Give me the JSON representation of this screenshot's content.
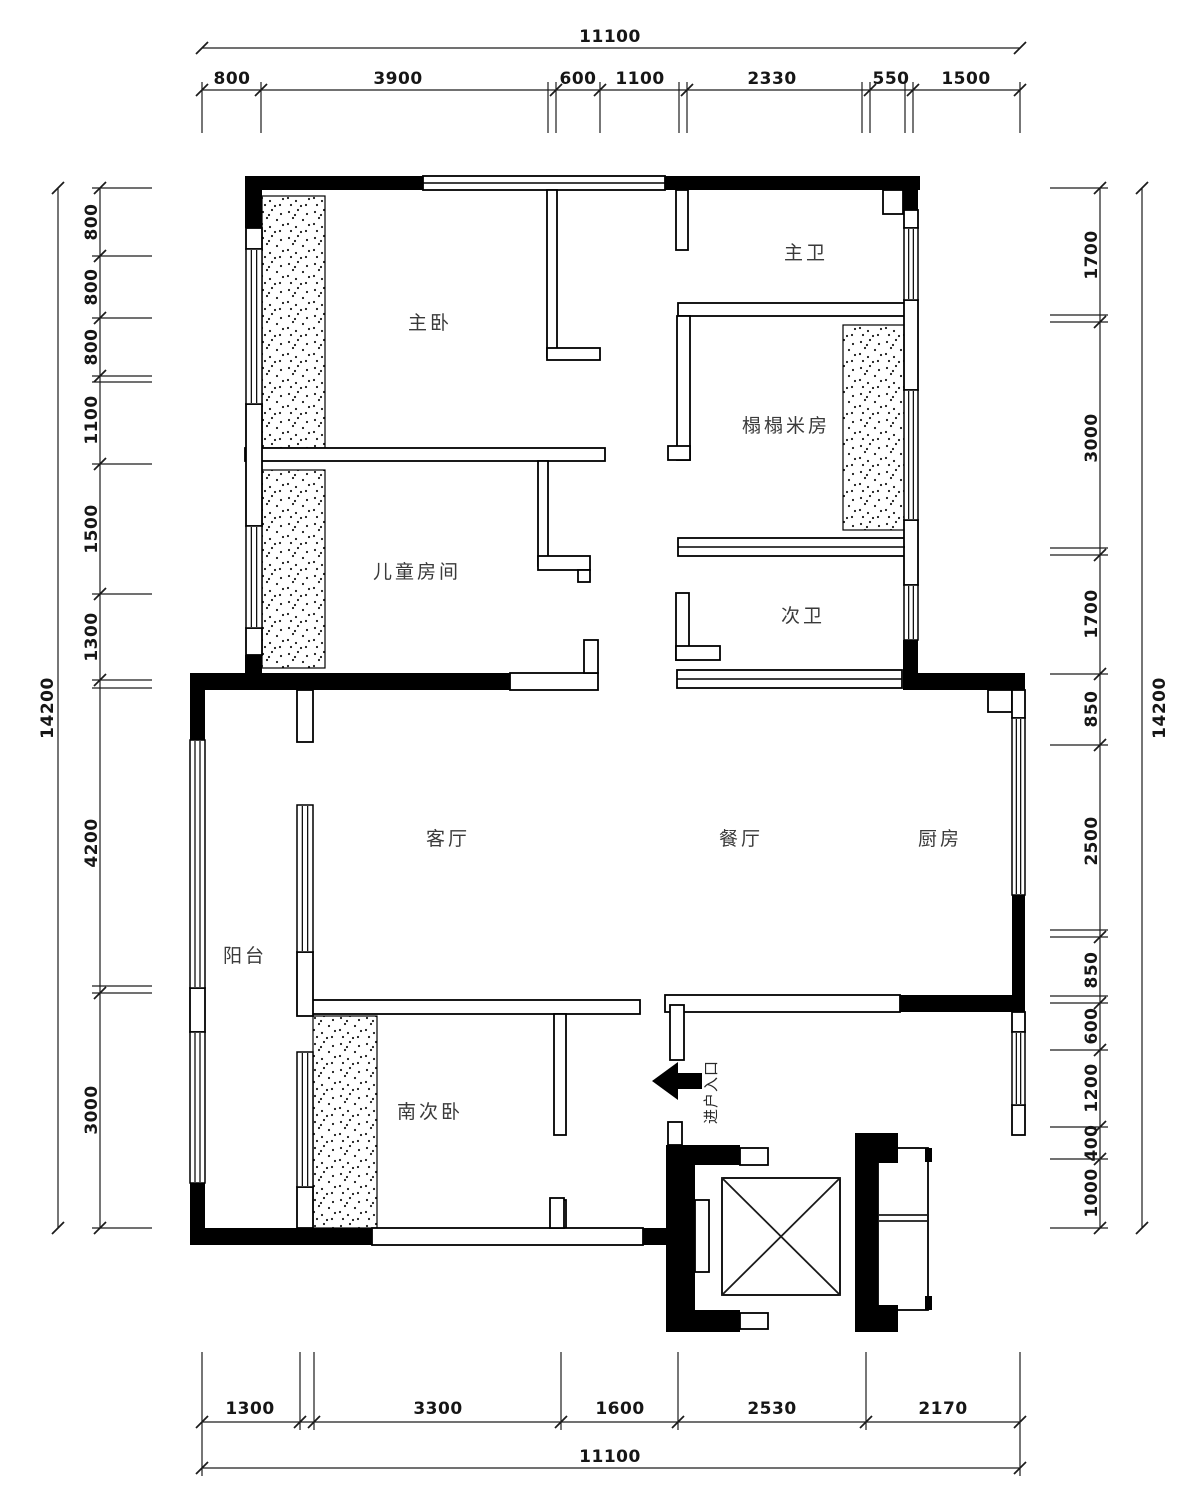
{
  "plan": {
    "rooms": {
      "master_bedroom": "主卧",
      "master_bath": "主卫",
      "tatami_room": "榻榻米房",
      "children_room": "儿童房间",
      "second_bath": "次卫",
      "living_room": "客厅",
      "dining_room": "餐厅",
      "kitchen": "厨房",
      "balcony": "阳台",
      "south_bedroom": "南次卧",
      "entrance": "进户入口"
    },
    "dims": {
      "top_total": "11100",
      "top": [
        "800",
        "3900",
        "600",
        "1100",
        "2330",
        "550",
        "1500"
      ],
      "bottom_total": "11100",
      "bottom": [
        "1300",
        "3300",
        "1600",
        "2530",
        "2170"
      ],
      "left_total": "14200",
      "left": [
        "800",
        "800",
        "800",
        "1100",
        "1500",
        "1300",
        "4200",
        "3000"
      ],
      "right_total": "14200",
      "right": [
        "1700",
        "3000",
        "1700",
        "850",
        "2500",
        "850",
        "600",
        "1200",
        "400",
        "1000"
      ]
    },
    "colors": {
      "wall": "#000000",
      "dim_line": "#1c1c1c",
      "room_label": "#3a3a3a",
      "background": "#ffffff"
    }
  }
}
